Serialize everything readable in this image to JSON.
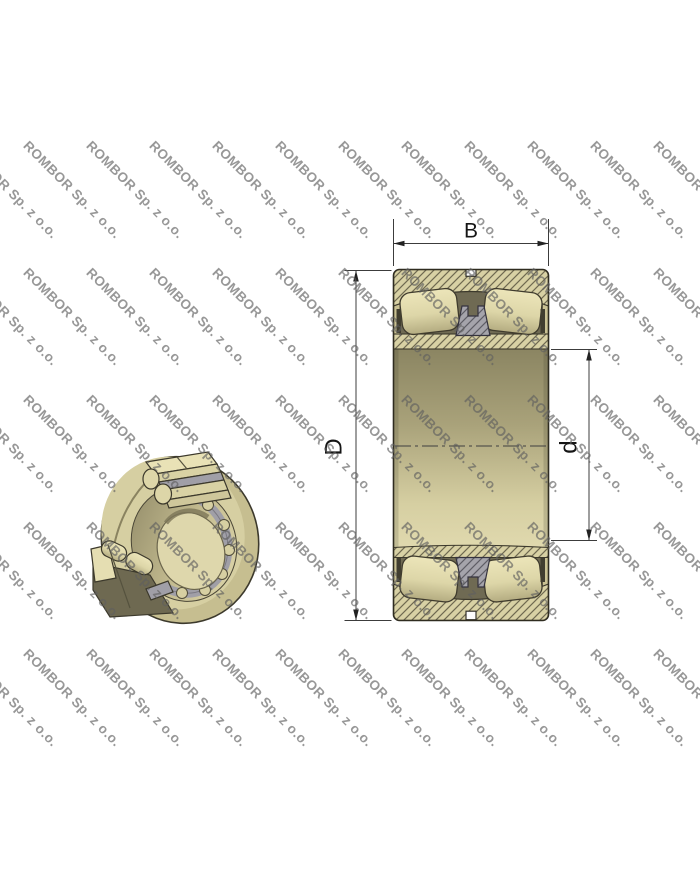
{
  "watermark": {
    "text": "ROMBOR Sp. z o.o.",
    "color": "rgba(95,95,95,0.65)",
    "font_size_px": 13.5,
    "rotation_deg": 45,
    "grid": {
      "x_start": -32,
      "x_step": 63,
      "cols": 12,
      "y_start": 138,
      "y_step": 127,
      "rows": 5
    }
  },
  "drawing": {
    "subject": "spherical roller bearing",
    "views": {
      "isometric_cutaway": {
        "description": "3D cutaway view of the bearing"
      },
      "cross_section": {
        "description": "Axial cross-section with dimension lines"
      }
    },
    "dimensions": {
      "width": {
        "label": "B"
      },
      "outer_diameter": {
        "label": "D"
      },
      "bore_diameter": {
        "label": "d"
      }
    },
    "colors": {
      "body_khaki": "#d8d1a4",
      "body_light": "#e9e2b6",
      "cavity_olive": "#6f6a53",
      "cage_gray": "#a09fa7",
      "outline": "#3c392c",
      "dimension_line": "#3c3c3c"
    }
  }
}
